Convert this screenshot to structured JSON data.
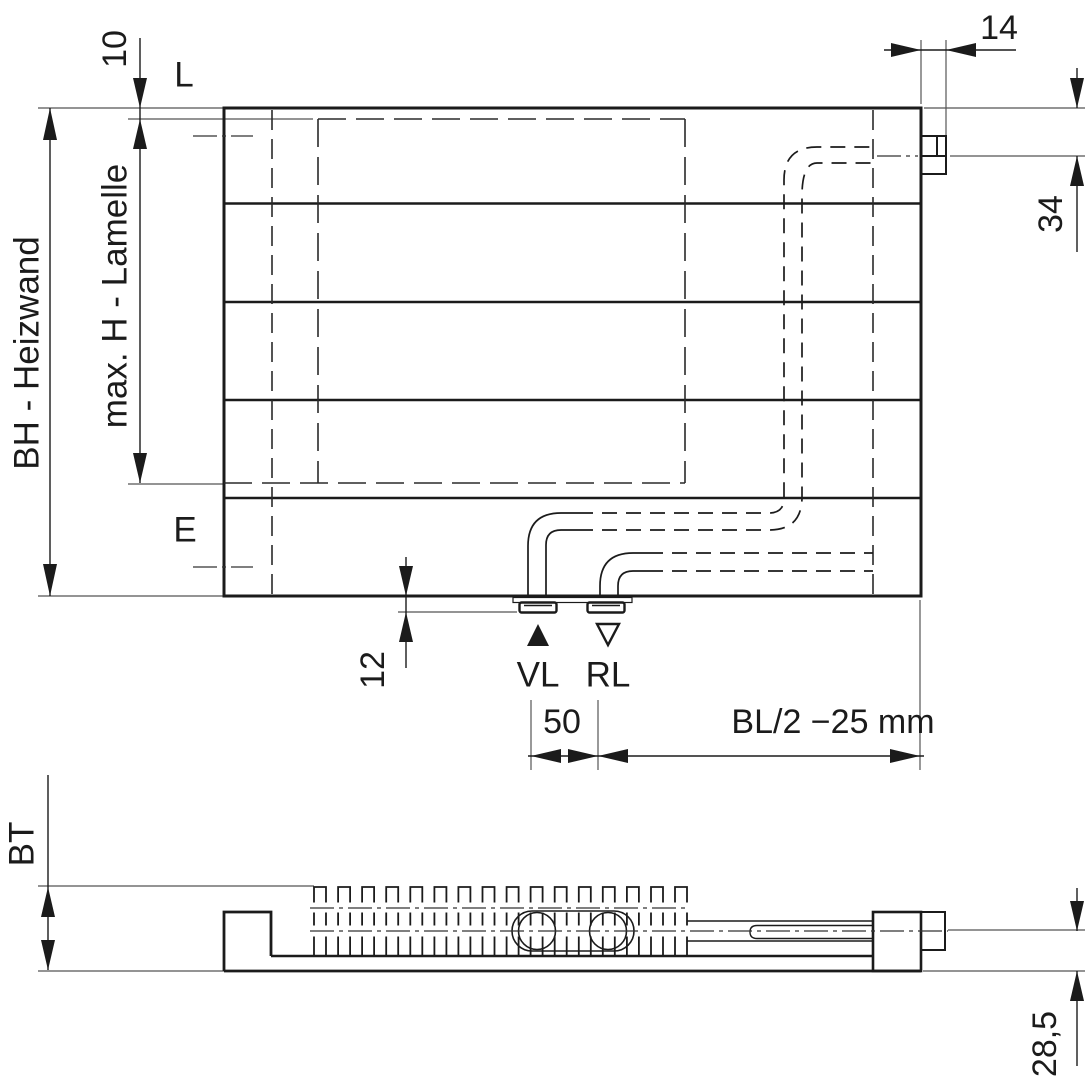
{
  "front_view": {
    "labels": {
      "height": "BH - Heizwand",
      "max_lamella": "max. H - Lamelle",
      "top_lug": "L",
      "bottom_lug": "E",
      "supply": "VL",
      "return": "RL"
    },
    "dims": {
      "top_offset": "10",
      "tab_width": "14",
      "tab_center_from_top": "34",
      "nipple_protrusion": "12",
      "pipe_spacing": "50",
      "connection_position": "BL/2 −25 mm"
    }
  },
  "side_view": {
    "labels": {
      "depth": "BT"
    },
    "dims": {
      "pipe_center_height": "28,5"
    }
  },
  "colors": {
    "line": "#1b1b1b",
    "thin_line": "#555555",
    "background": "#ffffff"
  }
}
